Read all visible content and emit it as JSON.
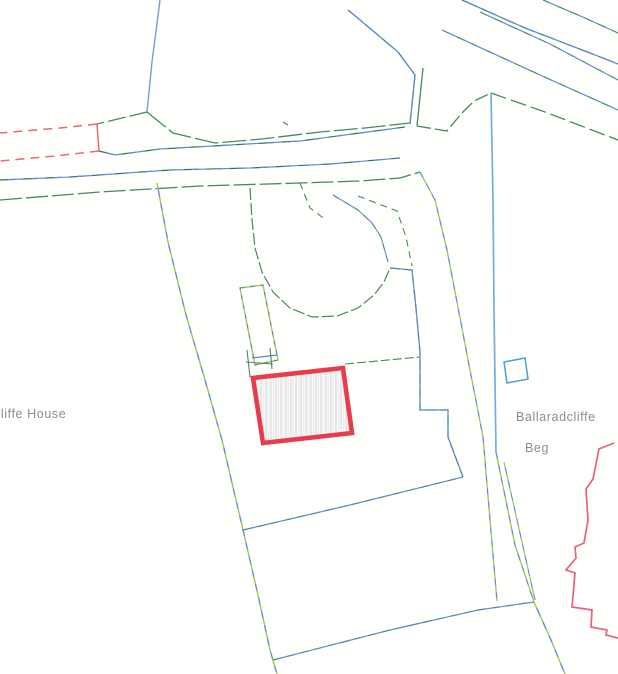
{
  "labels": {
    "house": "cliffe House",
    "townland_line1": "Ballaradcliffe",
    "townland_line2": "Beg"
  },
  "colors": {
    "subject_outline": "#ee3a4d",
    "boundary_teal": "#3f8a64",
    "boundary_teal_dark": "#2f7556",
    "boundary_blue": "#5b8fd6",
    "stream_blue": "#74aede",
    "boundary_yellow_green": "#aec23f",
    "red_dashed": "#f2666e",
    "adjacent_building_pink": "#ef5f85",
    "label_gray": "#8a8e91",
    "hatch_gray": "#dcdcdc"
  },
  "map": {
    "width": 618,
    "height": 674,
    "features": [
      {
        "name": "top-blue-line",
        "type": "polyline",
        "points": "160,0 152,62 147,112",
        "stroke": "#6f9fd8",
        "width": 1.4
      },
      {
        "name": "junction-left-arm",
        "type": "polyline",
        "points": "147,112 97,124",
        "stroke": "#3f8a64",
        "width": 1.3,
        "dash": "18 4"
      },
      {
        "name": "red-dash-upper",
        "type": "polyline",
        "points": "97,124 60,128 0,133",
        "stroke": "#f2666e",
        "width": 1.5,
        "dash": "9 6"
      },
      {
        "name": "red-connector",
        "type": "polyline",
        "points": "97,124 99,151",
        "stroke": "#f2666e",
        "width": 1.5
      },
      {
        "name": "red-dash-lower",
        "type": "polyline",
        "points": "99,151 55,156 0,161",
        "stroke": "#f2666e",
        "width": 1.5,
        "dash": "9 6"
      },
      {
        "name": "road-north-edge",
        "type": "polyline",
        "points": "147,112 173,133 215,143 262,139 320,132 365,128 410,123",
        "stroke": "#3f8a64",
        "width": 1.3,
        "dash": "24 4"
      },
      {
        "name": "road-center-boundary",
        "type": "polyline",
        "points": "99,151 115,155 160,149 230,145 300,141 360,133 405,127",
        "stroke": "#2f7556",
        "width": 1.2,
        "dash": "15 8",
        "alt_stroke": "#5b8fd6",
        "alt_offset": 15
      },
      {
        "name": "road-center-line-2",
        "type": "polyline",
        "points": "0,180 70,177 170,170 250,168 330,164 400,158",
        "stroke": "#2f7556",
        "width": 1.2,
        "dash": "15 8",
        "alt_stroke": "#5b8fd6",
        "alt_offset": 15
      },
      {
        "name": "road-south-edge",
        "type": "polyline",
        "points": "0,200 100,192 200,186 300,183 360,181 400,178 420,172",
        "stroke": "#3f8a64",
        "width": 1.3,
        "dash": "22 4"
      },
      {
        "name": "nw-road-edge",
        "type": "polyline",
        "points": "348,10 372,30 398,52 415,75 410,124",
        "stroke": "#3f8a64",
        "width": 1.3,
        "dash": "18 4",
        "alt_stroke": "#5b8fd6",
        "alt_offset": 18
      },
      {
        "name": "junction-neck-east",
        "type": "polyline",
        "points": "423,68 417,126",
        "stroke": "#3f8a64",
        "width": 1.3
      },
      {
        "name": "junction-notch",
        "type": "polyline",
        "points": "417,126 447,131 461,114 474,101 491,93",
        "stroke": "#3f8a64",
        "width": 1.3,
        "dash": "14 4"
      },
      {
        "name": "ne-road-north-edge",
        "type": "polyline",
        "points": "462,0 525,28 590,53 618,64",
        "stroke": "#3f8a64",
        "width": 1.3,
        "dash": "16 5",
        "alt_stroke": "#5b8fd6",
        "alt_offset": 16
      },
      {
        "name": "ne-road-dash-corner",
        "type": "polyline",
        "points": "543,0 585,18 618,33",
        "stroke": "#3f8a64",
        "width": 1.2,
        "dash": "8 7",
        "alt_stroke": "#5b8fd6",
        "alt_offset": 8
      },
      {
        "name": "ne-road-dash-1",
        "type": "polyline",
        "points": "480,12 550,44 618,80",
        "stroke": "#3f8a64",
        "width": 1.2,
        "dash": "9 7",
        "alt_stroke": "#5b8fd6",
        "alt_offset": 9
      },
      {
        "name": "ne-road-dash-2",
        "type": "polyline",
        "points": "442,30 540,75 618,110",
        "stroke": "#3f8a64",
        "width": 1.2,
        "dash": "9 7",
        "alt_stroke": "#5b8fd6",
        "alt_offset": 9
      },
      {
        "name": "ne-road-south-edge",
        "type": "polyline",
        "points": "491,93 545,112 618,140",
        "stroke": "#3f8a64",
        "width": 1.3,
        "dash": "16 5"
      },
      {
        "name": "stream-blue-solid",
        "type": "polyline",
        "points": "491,93 493,200 494,310 496,452",
        "stroke": "#74aede",
        "width": 1.7
      },
      {
        "name": "stream-dashed-continuation",
        "type": "polyline",
        "points": "496,452 515,545 534,602",
        "stroke": "#5b8fd6",
        "width": 1.3,
        "dash": "7 6",
        "alt_stroke": "#aec23f",
        "alt_offset": 7
      },
      {
        "name": "stream-dashed-parallel",
        "type": "polyline",
        "points": "504,462 522,542 535,600",
        "stroke": "#aec23f",
        "width": 1.2,
        "dash": "7 6",
        "alt_stroke": "#5b8fd6",
        "alt_offset": 7
      },
      {
        "name": "road-west-edge",
        "type": "polyline",
        "points": "420,172 435,200 447,250 470,370 483,437 490,520 497,601",
        "stroke": "#5b8fd6",
        "width": 1.3,
        "dash": "7 6",
        "alt_stroke": "#aec23f",
        "alt_offset": 7
      },
      {
        "name": "west-boundary",
        "type": "polyline",
        "points": "157,183 168,242 186,315 205,380 222,440 243,530 258,595 270,650 277,674",
        "stroke": "#aec23f",
        "width": 1.4,
        "dash": "7 7",
        "alt_stroke": "#5b8fd6",
        "alt_offset": 7
      },
      {
        "name": "field-line-1",
        "type": "polyline",
        "points": "243,530 350,505 463,477",
        "stroke": "#3f8a64",
        "width": 1.2,
        "dash": "9 5",
        "alt_stroke": "#5b8fd6",
        "alt_offset": 9
      },
      {
        "name": "field-line-2",
        "type": "polyline",
        "points": "273,660 390,630 478,610 534,602",
        "stroke": "#3f8a64",
        "width": 1.2,
        "dash": "9 5",
        "alt_stroke": "#5b8fd6",
        "alt_offset": 9
      },
      {
        "name": "se-continuation",
        "type": "polyline",
        "points": "534,602 551,640 565,674",
        "stroke": "#aec23f",
        "width": 1.4,
        "dash": "8 7",
        "alt_stroke": "#5b8fd6",
        "alt_offset": 8
      },
      {
        "name": "driveway-loop",
        "type": "polyline",
        "points": "250,188 252,220 255,248 262,272 273,292 290,308 312,317 337,316 358,308 374,295 384,282 390,268",
        "stroke": "#3f8a64",
        "width": 1.2,
        "dash": "12 3"
      },
      {
        "name": "diagonal-dash-1",
        "type": "polyline",
        "points": "300,183 310,208 326,220",
        "stroke": "#3f8a64",
        "width": 1.1,
        "dash": "7 5"
      },
      {
        "name": "diagonal-dash-2",
        "type": "polyline",
        "points": "333,195 358,210 372,223 381,237 388,262",
        "stroke": "#3f8a64",
        "width": 1.1,
        "dash": "7 5",
        "alt_stroke": "#5b8fd6",
        "alt_offset": 7
      },
      {
        "name": "diagonal-dash-3",
        "type": "polyline",
        "points": "358,196 397,211 406,237 412,266",
        "stroke": "#3f8a64",
        "width": 1.1,
        "dash": "7 5"
      },
      {
        "name": "stepped-boundary",
        "type": "polyline",
        "points": "390,268 412,270 416,308 420,352 420,410 448,410 448,437 463,477",
        "stroke": "#3f8a64",
        "width": 1.3,
        "dash": "10 4",
        "alt_stroke": "#5b8fd6",
        "alt_offset": 10
      },
      {
        "name": "narrow-building",
        "type": "polygon",
        "points": "240,288 263,285 278,360 255,365",
        "stroke": "#4a94a8",
        "width": 1.3,
        "dash": "6 4",
        "alt_stroke": "#aec23f",
        "alt_offset": 6
      },
      {
        "name": "narrow-building-divider",
        "type": "polyline",
        "points": "252,358 277,355",
        "stroke": "#4a94a8",
        "width": 1.2
      },
      {
        "name": "ladder-line-1",
        "type": "polyline",
        "points": "247,350 250,377",
        "stroke": "#3f8a64",
        "width": 1.1
      },
      {
        "name": "ladder-line-2",
        "type": "polyline",
        "points": "270,348 272,369",
        "stroke": "#3f8a64",
        "width": 1.1
      },
      {
        "name": "ladder-rung",
        "type": "polyline",
        "points": "246,362 273,364",
        "stroke": "#3f8a64",
        "width": 1.1
      },
      {
        "name": "subject-building",
        "type": "polygon",
        "points": "253,378 343,368 352,433 263,443",
        "stroke": "#ee3a4d",
        "width": 4.6,
        "fill": "url(#hatch)"
      },
      {
        "name": "building-tie-line",
        "type": "polyline",
        "points": "345,364 420,357",
        "stroke": "#3f8a64",
        "width": 1.1,
        "dash": "9 3"
      },
      {
        "name": "blue-square-outbuilding",
        "type": "polygon",
        "points": "504,362 525,358 528,379 507,383",
        "stroke": "#4f9fd0",
        "width": 1.5
      },
      {
        "name": "adjacent-building-outline",
        "type": "polyline",
        "points": "614,443 599,449 593,479 586,489 588,520 584,543 575,547 576,558 566,570 575,573 572,607 592,610 591,627 607,630 606,635 618,638",
        "stroke": "#ef5f85",
        "width": 1.7
      },
      {
        "name": "tiny-mark",
        "type": "polyline",
        "points": "283,122 288,125",
        "stroke": "#3f8a64",
        "width": 1.2
      }
    ]
  }
}
